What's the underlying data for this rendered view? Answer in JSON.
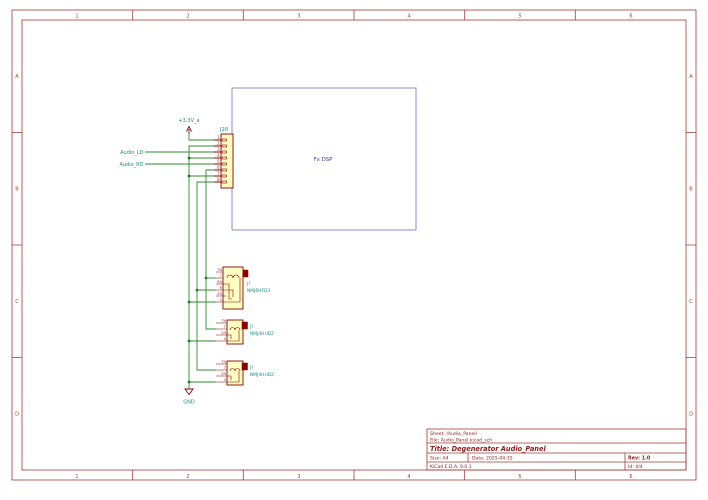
{
  "page": {
    "grid_cols": [
      "1",
      "2",
      "3",
      "4",
      "5",
      "6"
    ],
    "grid_rows": [
      "A",
      "B",
      "C",
      "D"
    ]
  },
  "colors": {
    "frame": "#a33c36",
    "wire_green": "#2e8b2e",
    "symbol_red": "#8b0000",
    "symbol_fill": "#fffec2",
    "field_teal": "#1e8c8c",
    "sheet_blue": "#8d8dcb",
    "sheet_text_blue": "#3a3aae"
  },
  "power": {
    "vcc_label": "+3.3V_a",
    "gnd_label": "GND"
  },
  "net_labels": {
    "audio_ld": "Audio_LD",
    "audio_rd": "Audio_RD"
  },
  "connector": {
    "ref": "J20",
    "pins": [
      "1",
      "2",
      "3",
      "4",
      "5",
      "6",
      "7",
      "8"
    ]
  },
  "hier_sheet": {
    "name": "Fx DSP"
  },
  "jacks": [
    {
      "ref": "J?",
      "value": "NMJ6HFD3",
      "pins": [
        "TN",
        "T",
        "RN",
        "R",
        "SN",
        "S"
      ]
    },
    {
      "ref": "J?",
      "value": "NMJ4HHD2",
      "pins": [
        "TN",
        "T",
        "SN",
        "S"
      ]
    },
    {
      "ref": "J?",
      "value": "NMJ4HHD2",
      "pins": [
        "TN",
        "T",
        "SN",
        "S"
      ]
    }
  ],
  "title_block": {
    "sheet": "Sheet: /Audio_Panel/",
    "file": "File: Audio_Panel.kicad_sch",
    "title": "Title: Degenerator Audio_Panel",
    "size": "Size: A4",
    "date": "Date: 2025-04-15",
    "rev": "Rev: 1.0",
    "tool": "KiCad E.D.A. 9.0.1",
    "id": "Id: 4/4"
  }
}
